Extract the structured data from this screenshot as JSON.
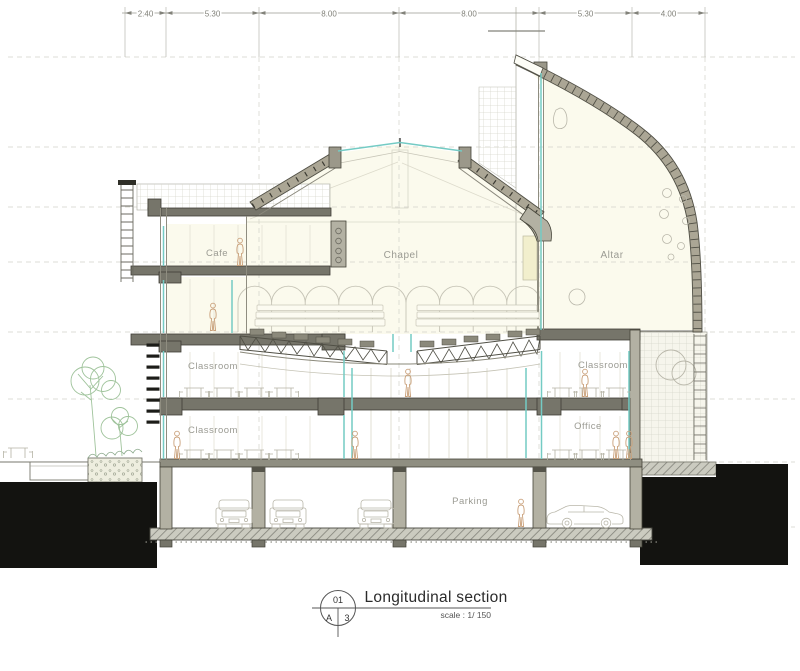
{
  "drawing_labels": {
    "cafe": "Cafe",
    "chapel": "Chapel",
    "altar": "Altar",
    "classroom_upper_left": "Classroom",
    "classroom_lower_left": "Classroom",
    "classroom_right": "Classroom",
    "office": "Office",
    "parking": "Parking"
  },
  "dimensions_m": [
    "2.40",
    "5.30",
    "8.00",
    "8.00",
    "5.30",
    "4.00"
  ],
  "title_block": {
    "detail_number": "01",
    "sheet_letter": "A",
    "sheet_number": "3",
    "title": "Longitudinal section",
    "scale": "scale : 1/ 150"
  },
  "colors": {
    "glazing_teal": "#74cbc4",
    "structure_dark": "#504f45",
    "wall_tan": "#aba695",
    "slab_gray": "#76756a",
    "ground_black": "#131310",
    "label_gray": "#9b9b93",
    "dimension_gray": "#82827a",
    "tree_green": "#9fc39b",
    "figure_tan": "#c9a07a",
    "interior_cream": "#fbfaed"
  }
}
